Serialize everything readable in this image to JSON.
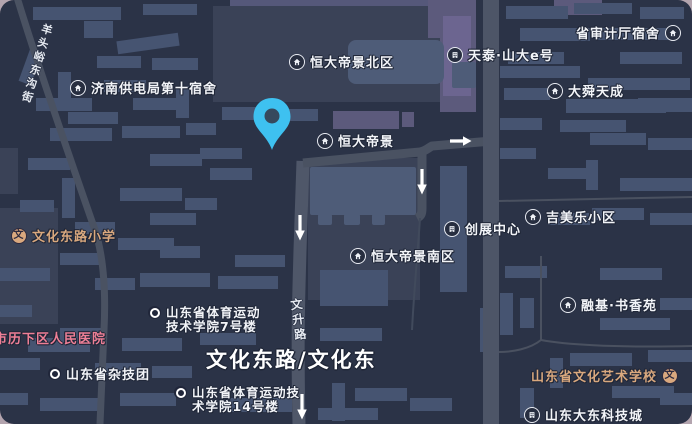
{
  "app": {
    "type": "dark-map-view"
  },
  "colors": {
    "page_background": "#b3a4ae",
    "map_background": "#2b3347",
    "building": "#465471",
    "building_light": "#4e5c78",
    "compound_block": "#3a4257",
    "purple_building": "#5c5a7c",
    "road": "#4a5262",
    "main_road": "#4d5567",
    "label_text": "#f2f4f8",
    "label_outline": "#1f2637",
    "school_label": "#d9a87e",
    "hospital_label": "#ee7f96",
    "pin": "#3ec1f0",
    "arrow": "#ffffff"
  },
  "icons": {
    "school_glyph": "文"
  },
  "pois": {
    "jinan_power_dorm": {
      "label": "济南供电局第十宿舍",
      "icon": "house"
    },
    "hengda_north": {
      "label": "恒大帝景北区",
      "icon": "house"
    },
    "tiantai_shanda": {
      "label": "天泰·山大e号",
      "icon": "building"
    },
    "audit_dorm": {
      "label": "省审计厅宿舍",
      "icon": "house"
    },
    "dashun": {
      "label": "大舜天成",
      "icon": "house"
    },
    "hengda": {
      "label": "恒大帝景",
      "icon": "house"
    },
    "chuangzhan": {
      "label": "创展中心",
      "icon": "building"
    },
    "jimeile": {
      "label": "吉美乐小区",
      "icon": "house"
    },
    "wenhua_primary": {
      "label": "文化东路小学",
      "icon": "school"
    },
    "hengda_south": {
      "label": "恒大帝景南区",
      "icon": "house"
    },
    "rongji": {
      "label": "融基·书香苑",
      "icon": "house"
    },
    "sports_college_7": {
      "line1": "山东省体育运动",
      "line2": "技术学院7号楼",
      "icon": "dot"
    },
    "lixia_hospital": {
      "label": "市历下区人民医院"
    },
    "zaji_troupe": {
      "label": "山东省杂技团",
      "icon": "dot"
    },
    "sports_college_14": {
      "line1": "山东省体育运动技",
      "line2": "术学院14号楼",
      "icon": "dot"
    },
    "art_school": {
      "label": "山东省文化艺术学校",
      "icon": "school"
    },
    "dadong_tech": {
      "label": "山东大东科技城",
      "icon": "building"
    }
  },
  "roads": {
    "wenhua_east_label": "文化东路/文化东",
    "wensheng_road": "文升路",
    "yangtouyu_street": "羊头峪东沟街"
  }
}
